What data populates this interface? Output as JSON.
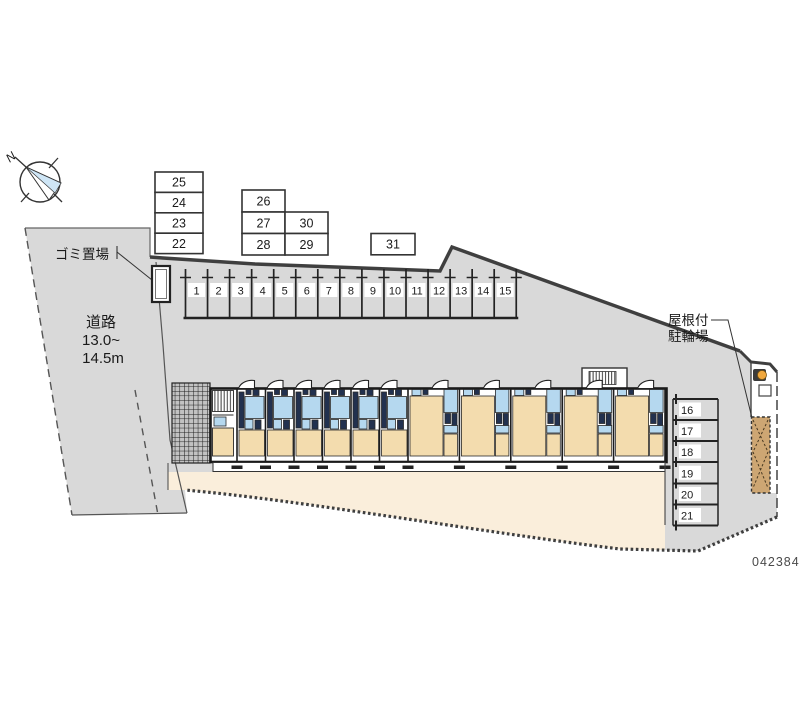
{
  "title": "apartment-site-plan",
  "plan_number": "042384",
  "compass": {
    "north_label": "N"
  },
  "labels": {
    "garbage": "ゴミ置場",
    "road": [
      "道路",
      "13.0~",
      "14.5m"
    ],
    "covered_bicycle_parking": [
      "屋根付",
      "駐輪場"
    ]
  },
  "parking": {
    "row_top": [
      "1",
      "2",
      "3",
      "4",
      "5",
      "6",
      "7",
      "8",
      "9",
      "10",
      "11",
      "12",
      "13",
      "14",
      "15"
    ],
    "column_right": [
      "16",
      "17",
      "18",
      "19",
      "20",
      "21"
    ],
    "block_left": [
      "25",
      "24",
      "23",
      "22"
    ],
    "block_mid_col1": [
      "26",
      "27",
      "28"
    ],
    "block_mid_col2": [
      "30",
      "29"
    ],
    "single_box": "31"
  },
  "building": {
    "left_unit_count": 6,
    "right_unit_count": 5
  },
  "colors": {
    "site_gray": "#d9d9d9",
    "courtyard_beige": "#faeedb",
    "room_tan": "#f3dcae",
    "water_blue": "#b5d8ef",
    "fixture_navy": "#22314f",
    "bike_shed_tan": "#cda673",
    "outline": "#1f1f1f",
    "boundary_gray": "#3f3f3f",
    "plan_number_gray": "#4a4a4a",
    "compass_blue": "#cfe6f6",
    "lamp_orange": "#f0a73c"
  }
}
